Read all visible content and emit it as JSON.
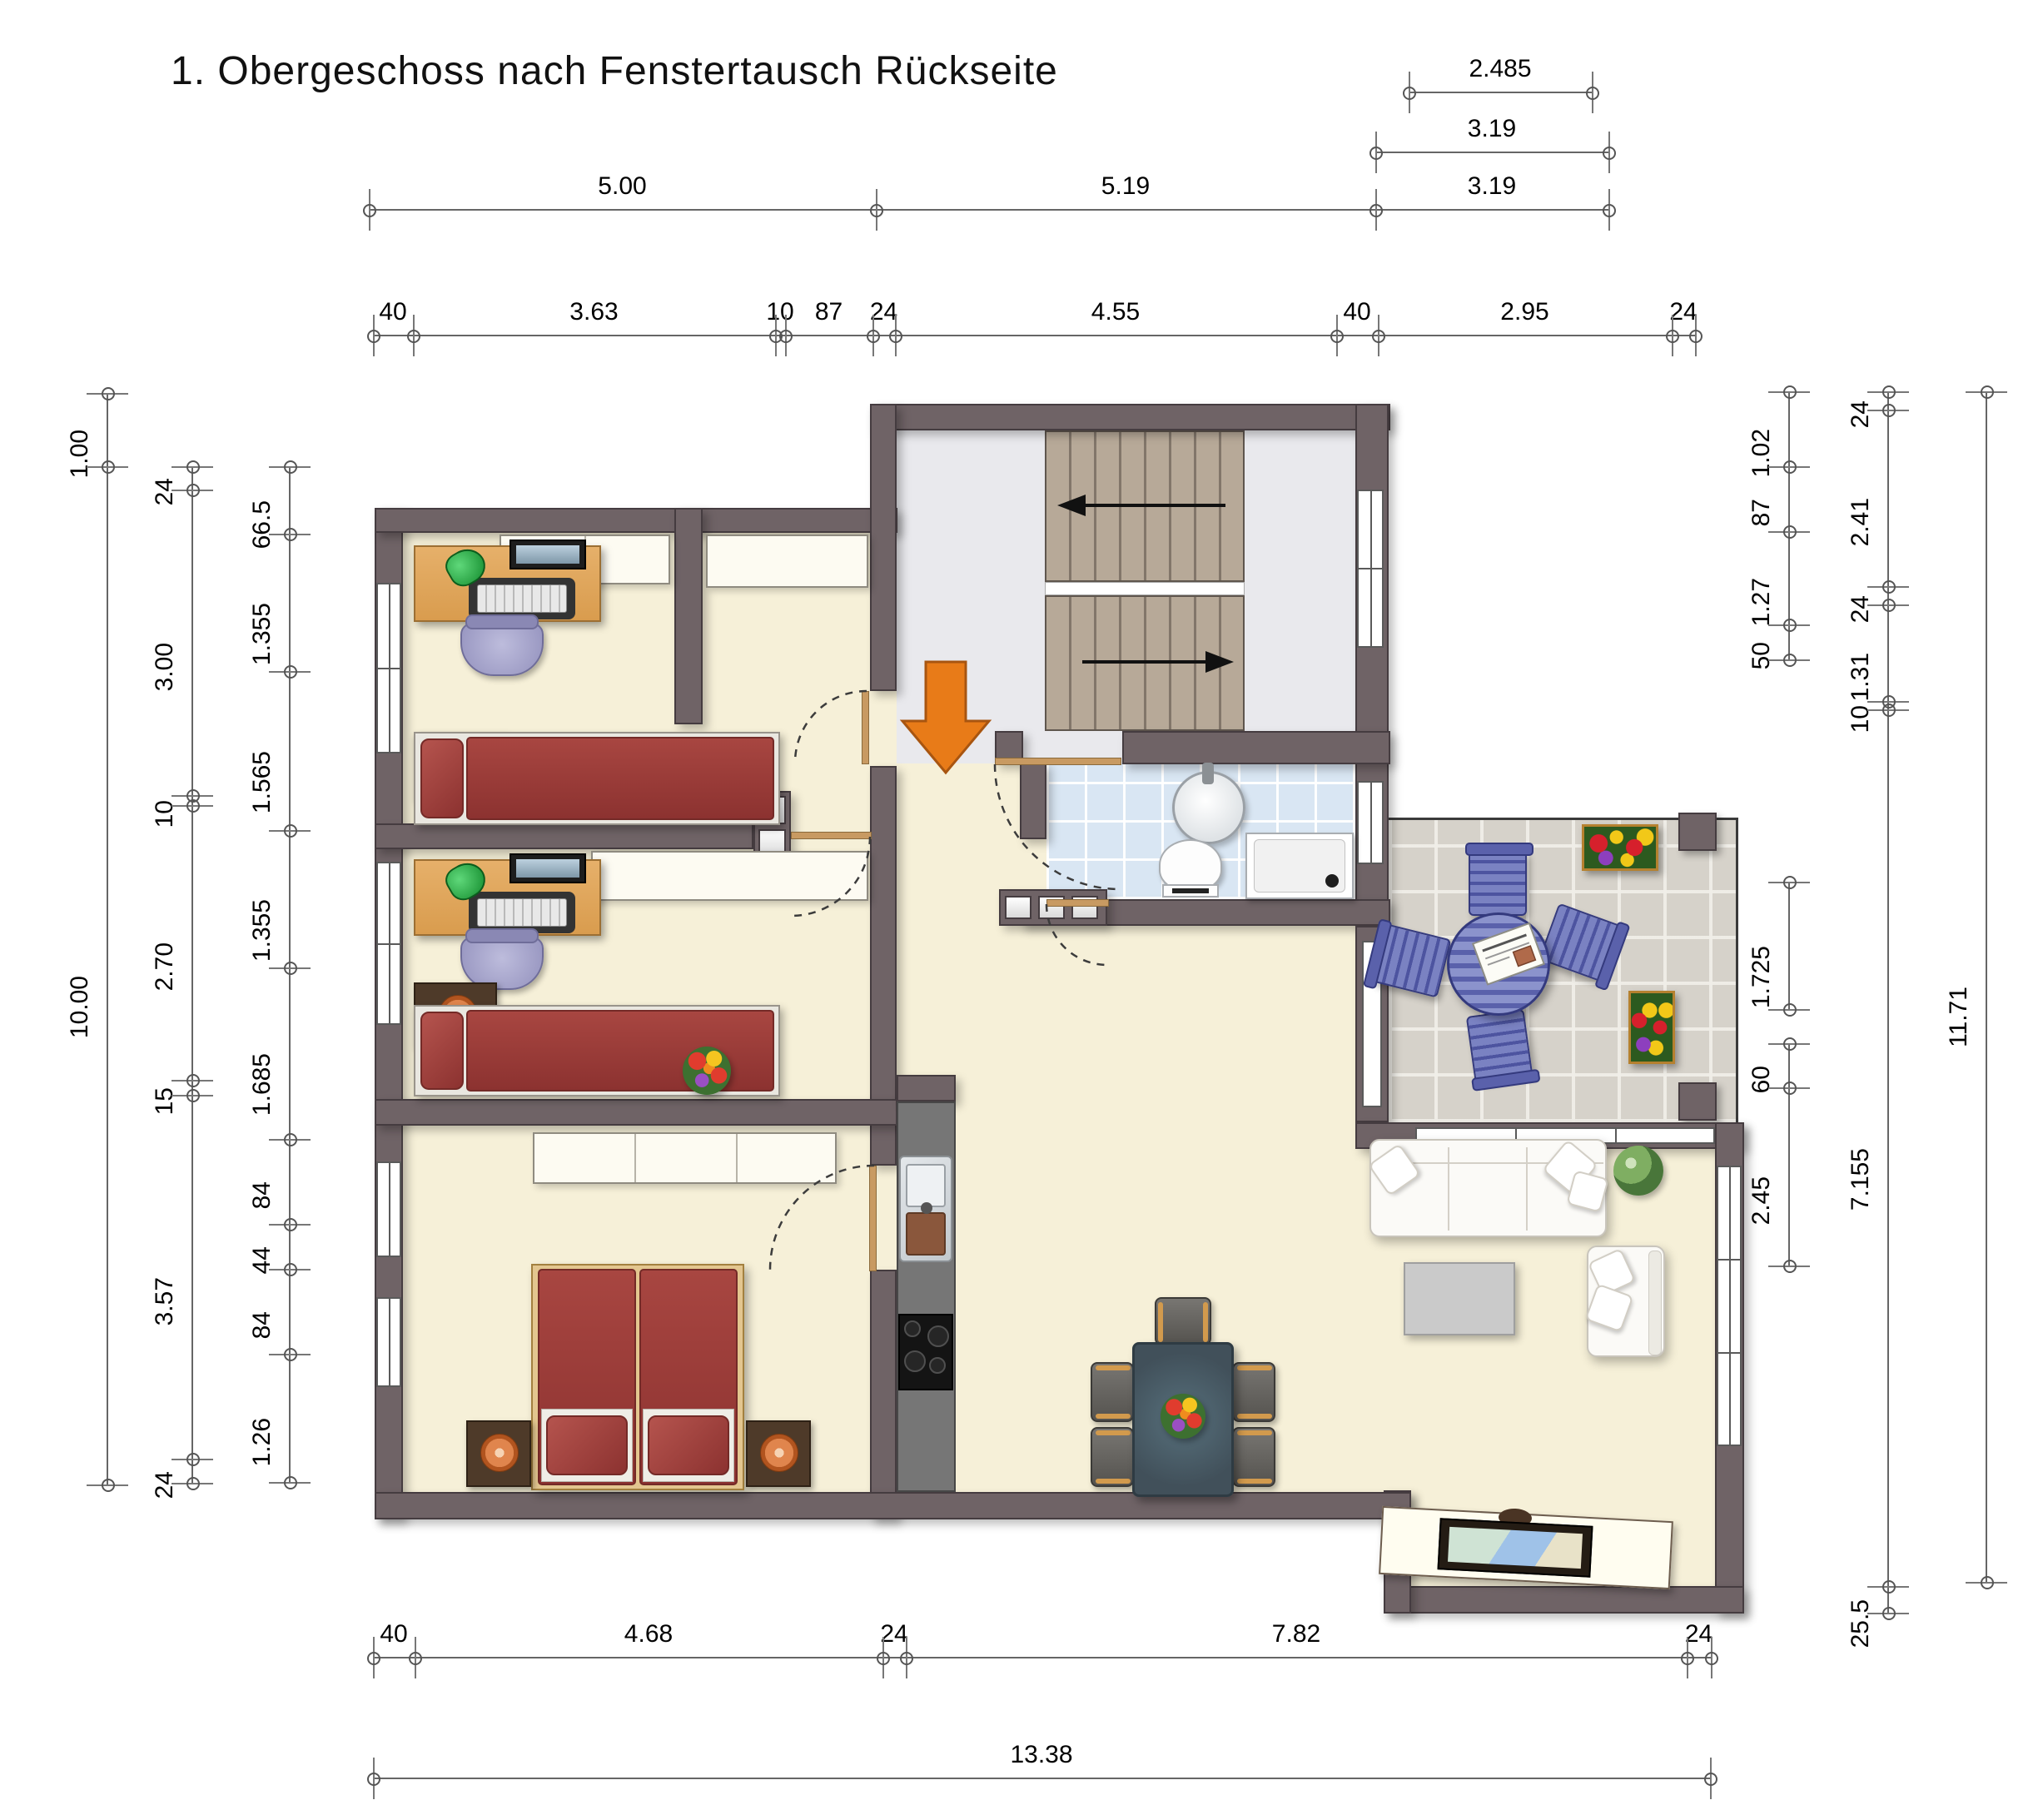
{
  "title": "1. Obergeschoss nach Fenstertausch Rückseite",
  "drawing_type": "floor-plan",
  "colors": {
    "wall": "#6f6366",
    "wall_outline": "#453c40",
    "floor": "#f6f0d8",
    "stairwell_floor": "#e9e9ed",
    "bath_tile": "#d9e6f3",
    "balcony_tile": "#d6d2ca",
    "bed": "#9d3c37",
    "desk_wood": "#dda055",
    "office_chair": "#a7a5c8",
    "kitchen_counter": "#767676",
    "dining_table": "#46565f",
    "balcony_furniture": "#5c63ae",
    "entrance_arrow": "#e87b18",
    "stair_tread": "#b7a998"
  },
  "furniture_icons": [
    "stairs-icon",
    "entrance-arrow-icon",
    "single-bed-icon",
    "double-bed-icon",
    "desk-icon",
    "monitor-icon",
    "keyboard-icon",
    "desk-lamp-icon",
    "office-chair-icon",
    "nightstand-icon",
    "wardrobe-icon",
    "closet-icon",
    "sink-icon",
    "toilet-icon",
    "shower-icon",
    "kitchen-sink-icon",
    "cooktop-icon",
    "dining-table-icon",
    "dining-chair-icon",
    "sofa-icon",
    "armchair-icon",
    "coffee-table-icon",
    "tv-sideboard-icon",
    "balcony-table-icon",
    "balcony-chair-icon",
    "newspaper-icon",
    "flower-box-icon",
    "plant-icon",
    "door-swing-icon"
  ],
  "dimension_chains": [
    {
      "id": "top-aux-1",
      "orient": "h",
      "pos": 110,
      "segments": [
        {
          "label": "2.485",
          "a": 1692,
          "b": 1912
        }
      ]
    },
    {
      "id": "top-aux-2",
      "orient": "h",
      "pos": 182,
      "segments": [
        {
          "label": "3.19",
          "a": 1652,
          "b": 1932
        }
      ]
    },
    {
      "id": "top-main",
      "orient": "h",
      "pos": 251,
      "segments": [
        {
          "label": "5.00",
          "a": 443,
          "b": 1052
        },
        {
          "label": "5.19",
          "a": 1052,
          "b": 1652
        },
        {
          "label": "3.19",
          "a": 1652,
          "b": 1932
        }
      ]
    },
    {
      "id": "top-detail",
      "orient": "h",
      "pos": 402,
      "segments": [
        {
          "label": "40",
          "a": 448,
          "b": 496
        },
        {
          "label": "3.63",
          "a": 496,
          "b": 931
        },
        {
          "label": "10",
          "a": 931,
          "b": 943
        },
        {
          "label": "87",
          "a": 943,
          "b": 1048
        },
        {
          "label": "24",
          "a": 1048,
          "b": 1075
        },
        {
          "label": "4.55",
          "a": 1075,
          "b": 1605
        },
        {
          "label": "40",
          "a": 1605,
          "b": 1655
        },
        {
          "label": "2.95",
          "a": 1655,
          "b": 2008
        },
        {
          "label": "24",
          "a": 2008,
          "b": 2036
        }
      ]
    },
    {
      "id": "left-outer",
      "orient": "v",
      "pos": 128,
      "segments": [
        {
          "label": "1.00",
          "a": 472,
          "b": 560
        },
        {
          "label": "10.00",
          "a": 560,
          "b": 1783
        }
      ]
    },
    {
      "id": "left-mid",
      "orient": "v",
      "pos": 230,
      "segments": [
        {
          "label": "24",
          "a": 560,
          "b": 588
        },
        {
          "label": "3.00",
          "a": 588,
          "b": 955
        },
        {
          "label": "10",
          "a": 955,
          "b": 967
        },
        {
          "label": "2.70",
          "a": 967,
          "b": 1297
        },
        {
          "label": "15",
          "a": 1297,
          "b": 1315
        },
        {
          "label": "3.57",
          "a": 1315,
          "b": 1752
        },
        {
          "label": "24",
          "a": 1752,
          "b": 1781
        }
      ]
    },
    {
      "id": "left-inner",
      "orient": "v",
      "pos": 347,
      "segments": [
        {
          "label": "66.5",
          "a": 560,
          "b": 641
        },
        {
          "label": "1.355",
          "a": 641,
          "b": 806
        },
        {
          "label": "1.565",
          "a": 806,
          "b": 997
        },
        {
          "label": "1.355",
          "a": 997,
          "b": 1162
        },
        {
          "label": "1.685",
          "a": 1162,
          "b": 1368
        },
        {
          "label": "84",
          "a": 1368,
          "b": 1470
        },
        {
          "label": "44",
          "a": 1470,
          "b": 1524
        },
        {
          "label": "84",
          "a": 1524,
          "b": 1626
        },
        {
          "label": "1.26",
          "a": 1626,
          "b": 1780
        }
      ]
    },
    {
      "id": "right-inner",
      "orient": "v",
      "pos": 2148,
      "segments": [
        {
          "label": "1.02",
          "a": 470,
          "b": 560
        },
        {
          "label": "87",
          "a": 560,
          "b": 638
        },
        {
          "label": "1.27",
          "a": 638,
          "b": 750
        },
        {
          "label": "50",
          "a": 750,
          "b": 792
        },
        {
          "label": "1.725",
          "a": 1059,
          "b": 1212
        },
        {
          "label": "60",
          "a": 1253,
          "b": 1306
        },
        {
          "label": "2.45",
          "a": 1306,
          "b": 1520
        }
      ]
    },
    {
      "id": "right-mid",
      "orient": "v",
      "pos": 2267,
      "segments": [
        {
          "label": "24",
          "a": 470,
          "b": 492
        },
        {
          "label": "2.41",
          "a": 492,
          "b": 704
        },
        {
          "label": "24",
          "a": 704,
          "b": 726
        },
        {
          "label": "1.31",
          "a": 726,
          "b": 842
        },
        {
          "label": "10",
          "a": 842,
          "b": 852
        },
        {
          "label": "7.155",
          "a": 852,
          "b": 1905
        },
        {
          "label": "25.5",
          "a": 1905,
          "b": 1937
        }
      ]
    },
    {
      "id": "right-outer",
      "orient": "v",
      "pos": 2385,
      "segments": [
        {
          "label": "11.71",
          "a": 470,
          "b": 1900
        }
      ]
    },
    {
      "id": "bottom-detail",
      "orient": "h",
      "pos": 1990,
      "segments": [
        {
          "label": "40",
          "a": 448,
          "b": 498
        },
        {
          "label": "4.68",
          "a": 498,
          "b": 1060
        },
        {
          "label": "24",
          "a": 1060,
          "b": 1088
        },
        {
          "label": "7.82",
          "a": 1088,
          "b": 2026
        },
        {
          "label": "24",
          "a": 2026,
          "b": 2055
        }
      ]
    },
    {
      "id": "bottom-total",
      "orient": "h",
      "pos": 2135,
      "segments": [
        {
          "label": "13.38",
          "a": 448,
          "b": 2054
        }
      ]
    }
  ]
}
